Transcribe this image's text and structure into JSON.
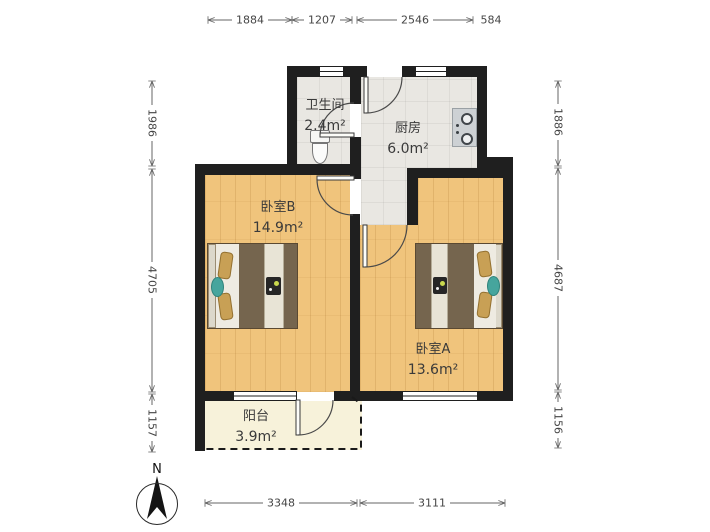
{
  "plan": {
    "compass": {
      "label": "N"
    },
    "rooms": {
      "bathroom": {
        "name": "卫生间",
        "area": "2.4m²"
      },
      "kitchen": {
        "name": "厨房",
        "area": "6.0m²"
      },
      "bedroom_b": {
        "name": "卧室B",
        "area": "14.9m²"
      },
      "bedroom_a": {
        "name": "卧室A",
        "area": "13.6m²"
      },
      "balcony": {
        "name": "阳台",
        "area": "3.9m²"
      }
    },
    "dimensions_mm": {
      "top": [
        "1884",
        "1207",
        "2546",
        "584"
      ],
      "bottom": [
        "3348",
        "3111"
      ],
      "left": [
        "1986",
        "4705",
        "1157"
      ],
      "right": [
        "1886",
        "4687",
        "1156"
      ]
    },
    "colors": {
      "wall": "#1f1f1f",
      "wood_floor": "#f0c47c",
      "tile_floor": "#e9e7e2",
      "balcony_floor": "#f7f2da",
      "bed_blanket": "#75654e",
      "bed_sheet": "#eeebe2",
      "pillow": "#c8a055",
      "accent_teal": "#46a59d",
      "dimension_text": "#454545"
    }
  }
}
